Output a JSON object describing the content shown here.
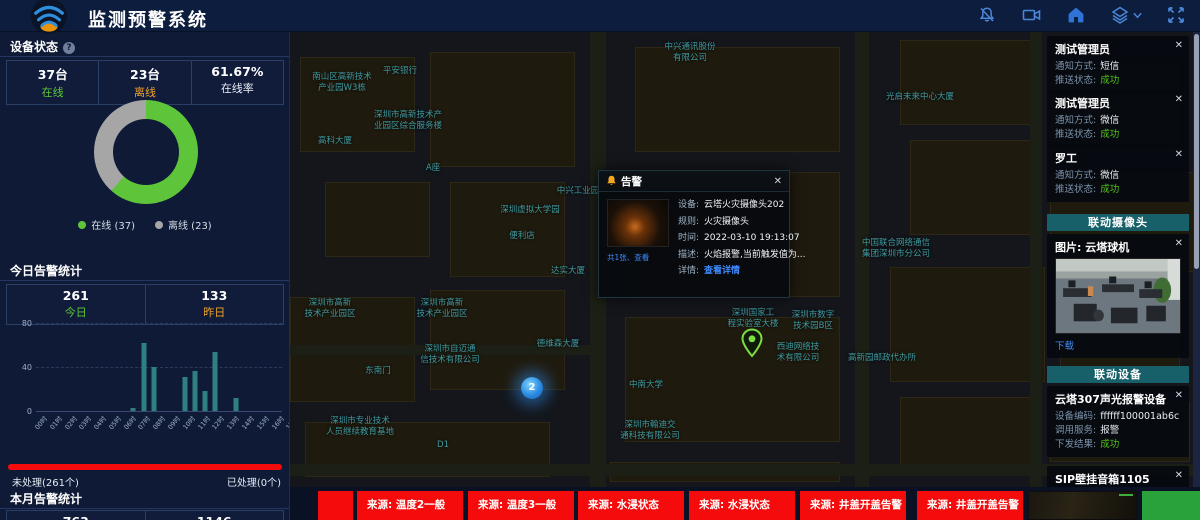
{
  "ui": {
    "close_glyph": "✕"
  },
  "header": {
    "title": "监测预警系统",
    "icons": [
      "bell-muted-icon",
      "video-camera-icon",
      "home-icon",
      "layers-icon",
      "fullscreen-icon"
    ]
  },
  "device_status": {
    "title": "设备状态",
    "help_icon": "?",
    "stats": [
      {
        "value": "37台",
        "label": "在线",
        "color": "green"
      },
      {
        "value": "23台",
        "label": "离线",
        "color": "orange"
      },
      {
        "value": "61.67%",
        "label": "在线率",
        "color": "plain"
      }
    ],
    "chart_data": {
      "type": "pie",
      "labels": [
        "在线",
        "离线"
      ],
      "values": [
        37,
        23
      ],
      "colors": [
        "#5ec53a",
        "#a6a6a6"
      ],
      "donut": true
    },
    "legend": [
      {
        "label": "在线 (37)",
        "color": "#5ec53a"
      },
      {
        "label": "离线 (23)",
        "color": "#a6a6a6"
      }
    ]
  },
  "today_alarms": {
    "title": "今日告警统计",
    "stats": [
      {
        "value": "261",
        "label": "今日",
        "color": "green"
      },
      {
        "value": "133",
        "label": "昨日",
        "color": "orange"
      }
    ],
    "chart_data": {
      "type": "bar",
      "categories": [
        "00时",
        "01时",
        "02时",
        "03时",
        "04时",
        "05时",
        "06时",
        "07时",
        "08时",
        "09时",
        "10时",
        "11时",
        "12时",
        "13时",
        "14时",
        "15时",
        "16时",
        "17时",
        "18时",
        "19时",
        "20时",
        "21时",
        "22时",
        "23时"
      ],
      "values": [
        0,
        0,
        0,
        0,
        0,
        0,
        0,
        0,
        0,
        3,
        62,
        40,
        0,
        0,
        31,
        36,
        18,
        54,
        0,
        12,
        0,
        0,
        0,
        0
      ],
      "ylim": [
        0,
        80
      ],
      "yticks": [
        0,
        40,
        80
      ],
      "bar_color": "#2f8081"
    },
    "progress": {
      "unhandled": {
        "label": "未处理(261个)",
        "color": "#f50b0b"
      },
      "handled": {
        "label": "已处理(0个)",
        "color": "#52c41a"
      }
    }
  },
  "month_alarms": {
    "title": "本月告警统计",
    "stats": [
      {
        "value": "763",
        "label": "",
        "color": "plain"
      },
      {
        "value": "1146",
        "label": "",
        "color": "plain"
      }
    ]
  },
  "map": {
    "labels": [
      {
        "text": "中兴通讯股份\n有限公司",
        "x": 400,
        "y": 10
      },
      {
        "text": "平安银行",
        "x": 110,
        "y": 34
      },
      {
        "text": "南山区高新技术\n产业园W3栋",
        "x": 52,
        "y": 40
      },
      {
        "text": "光启未来中心大厦",
        "x": 630,
        "y": 60
      },
      {
        "text": "深圳市高新技术产\n业园区综合服务楼",
        "x": 118,
        "y": 78
      },
      {
        "text": "高科大厦",
        "x": 45,
        "y": 104
      },
      {
        "text": "A座",
        "x": 143,
        "y": 131
      },
      {
        "text": "中兴工业园",
        "x": 288,
        "y": 154
      },
      {
        "text": "深圳虚拟大学园",
        "x": 240,
        "y": 173
      },
      {
        "text": "便利店",
        "x": 232,
        "y": 199
      },
      {
        "text": "中国联合网络通信\n集团深圳市分公司",
        "x": 606,
        "y": 206
      },
      {
        "text": "达实大厦",
        "x": 278,
        "y": 234
      },
      {
        "text": "深圳市高新\n技术产业园区",
        "x": 40,
        "y": 266
      },
      {
        "text": "深圳市高新\n技术产业园区",
        "x": 152,
        "y": 266
      },
      {
        "text": "德维森大厦",
        "x": 268,
        "y": 307
      },
      {
        "text": "深圳市自迈通\n信技术有限公司",
        "x": 160,
        "y": 312
      },
      {
        "text": "东南门",
        "x": 88,
        "y": 334
      },
      {
        "text": "深圳市专业技术\n人员继续教育基地",
        "x": 70,
        "y": 384
      },
      {
        "text": "深圳国家工\n程实验室大楼",
        "x": 463,
        "y": 276
      },
      {
        "text": "深圳市数字\n技术园B区",
        "x": 523,
        "y": 278
      },
      {
        "text": "西迪网络技\n术有限公司",
        "x": 508,
        "y": 310
      },
      {
        "text": "高新园邮政代办所",
        "x": 592,
        "y": 321
      },
      {
        "text": "中南大学",
        "x": 356,
        "y": 348
      },
      {
        "text": "深圳市翰迪交\n通科技有限公司",
        "x": 360,
        "y": 388
      },
      {
        "text": "D1",
        "x": 153,
        "y": 408
      }
    ],
    "markers": {
      "cluster": {
        "text": "2",
        "x": 242,
        "y": 356
      },
      "pin": {
        "x": 462,
        "y": 296
      }
    }
  },
  "alert_popup": {
    "title": "告警",
    "thumb_caption": "共1张、查看",
    "rows": [
      {
        "label": "设备:",
        "value": "云塔火灾摄像头202"
      },
      {
        "label": "规则:",
        "value": "火灾摄像头"
      },
      {
        "label": "时间:",
        "value": "2022-03-10 19:13:07"
      },
      {
        "label": "描述:",
        "value": "火焰报警,当前触发值为..."
      },
      {
        "label": "详情:",
        "value": "查看详情",
        "link": true
      }
    ]
  },
  "notifications": [
    {
      "name": "测试管理员",
      "rows": [
        {
          "label": "通知方式:",
          "value": "短信"
        },
        {
          "label": "推送状态:",
          "value": "成功",
          "success": true
        }
      ]
    },
    {
      "name": "测试管理员",
      "rows": [
        {
          "label": "通知方式:",
          "value": "微信"
        },
        {
          "label": "推送状态:",
          "value": "成功",
          "success": true
        }
      ]
    },
    {
      "name": "罗工",
      "rows": [
        {
          "label": "通知方式:",
          "value": "微信"
        },
        {
          "label": "推送状态:",
          "value": "成功",
          "success": true
        }
      ]
    }
  ],
  "linked_camera": {
    "header": "联动摄像头",
    "card_title": "图片: 云塔球机",
    "download_label": "下载"
  },
  "linked_devices": {
    "header": "联动设备",
    "cards": [
      {
        "title": "云塔307声光报警设备",
        "rows": [
          {
            "label": "设备编码:",
            "value": "ffffff100001ab6c"
          },
          {
            "label": "调用服务:",
            "value": "报警"
          },
          {
            "label": "下发结果:",
            "value": "成功",
            "success": true
          }
        ]
      },
      {
        "title": "SIP壁挂音箱1105",
        "rows": [
          {
            "label": "设备编码:",
            "value": "1105"
          }
        ]
      }
    ]
  },
  "bottom_alerts": {
    "tiles": [
      {
        "text": ""
      },
      {
        "text": "来源: 温度2一般"
      },
      {
        "text": "来源: 温度3一般"
      },
      {
        "text": "来源: 水浸状态"
      },
      {
        "text": "来源: 水浸状态"
      },
      {
        "text": "来源: 井盖开盖告警"
      },
      {
        "text": "来源: 井盖开盖告警"
      }
    ]
  }
}
